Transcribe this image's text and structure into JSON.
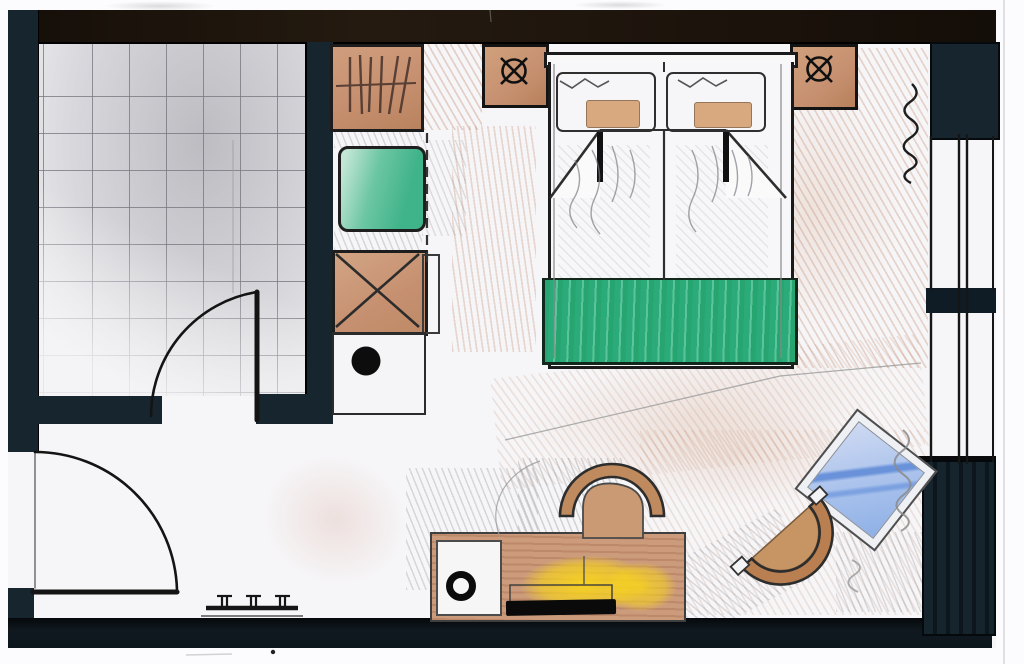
{
  "meta": {
    "kind": "hand-drawn interior floor plan",
    "media": "ink and colored pencil sketch, scanned"
  },
  "palette": {
    "margin": "#fcfcfe",
    "floor": "#f6f5f7",
    "wall_navy": "#17252f",
    "wall_top": "#201710",
    "wall_black": "#0c141b",
    "tile_line": "#9a9aa0",
    "tan": "#c69070",
    "tan_deep": "#b97f54",
    "green": "#3fb389",
    "runner_green": "#2bab79",
    "yellow": "#f7d32e",
    "blue": "#a9c2ec",
    "blue_streak": "#5d89d6",
    "ink": "#1c1c1c",
    "pencil": "#8d8d92"
  },
  "elements": {
    "plan": {
      "label": "Hand-drawn hotel room floor plan"
    },
    "bathroom": {
      "label": "Bathroom with tiled floor"
    },
    "bathroom_door": {
      "label": "Bathroom door with swing arc"
    },
    "entry_door": {
      "label": "Entry door with swing arc"
    },
    "wardrobe": {
      "label": "Wardrobe with clothes hangers"
    },
    "green_cabinet": {
      "label": "Cabinet unit with green top"
    },
    "minibar": {
      "label": "Cabinet marked with X (minibar)"
    },
    "vanity": {
      "label": "Counter with round basin"
    },
    "bed": {
      "label": "Double bed with folded duvet corners"
    },
    "pillow_left": {
      "label": "Left pillow"
    },
    "pillow_right": {
      "label": "Right pillow"
    },
    "bed_runner": {
      "label": "Green bed runner"
    },
    "nightstand_left": {
      "label": "Left bedside cabinet with lamp symbol"
    },
    "nightstand_right": {
      "label": "Right bedside cabinet with lamp symbol"
    },
    "lamp_symbol": {
      "label": "Lamp symbol (circle with cross)"
    },
    "desk": {
      "label": "Desk sideboard along bottom wall"
    },
    "desk_compartment": {
      "label": "Desk compartment with round object"
    },
    "desk_glow": {
      "label": "Yellow lamp glow on desk"
    },
    "desk_laptop": {
      "label": "Dark object on desk"
    },
    "desk_chair": {
      "label": "Curved desk chair"
    },
    "tub_chair": {
      "label": "Round lounge chair"
    },
    "side_table": {
      "label": "Tilted glass side table"
    },
    "bench": {
      "label": "Small luggage bench"
    },
    "window_upper": {
      "label": "Upper window in right wall"
    },
    "window_lower": {
      "label": "Lower window in right wall"
    },
    "curtain": {
      "label": "Curtain squiggle symbol"
    },
    "guides": {
      "label": "Faint pencil guide lines"
    }
  }
}
